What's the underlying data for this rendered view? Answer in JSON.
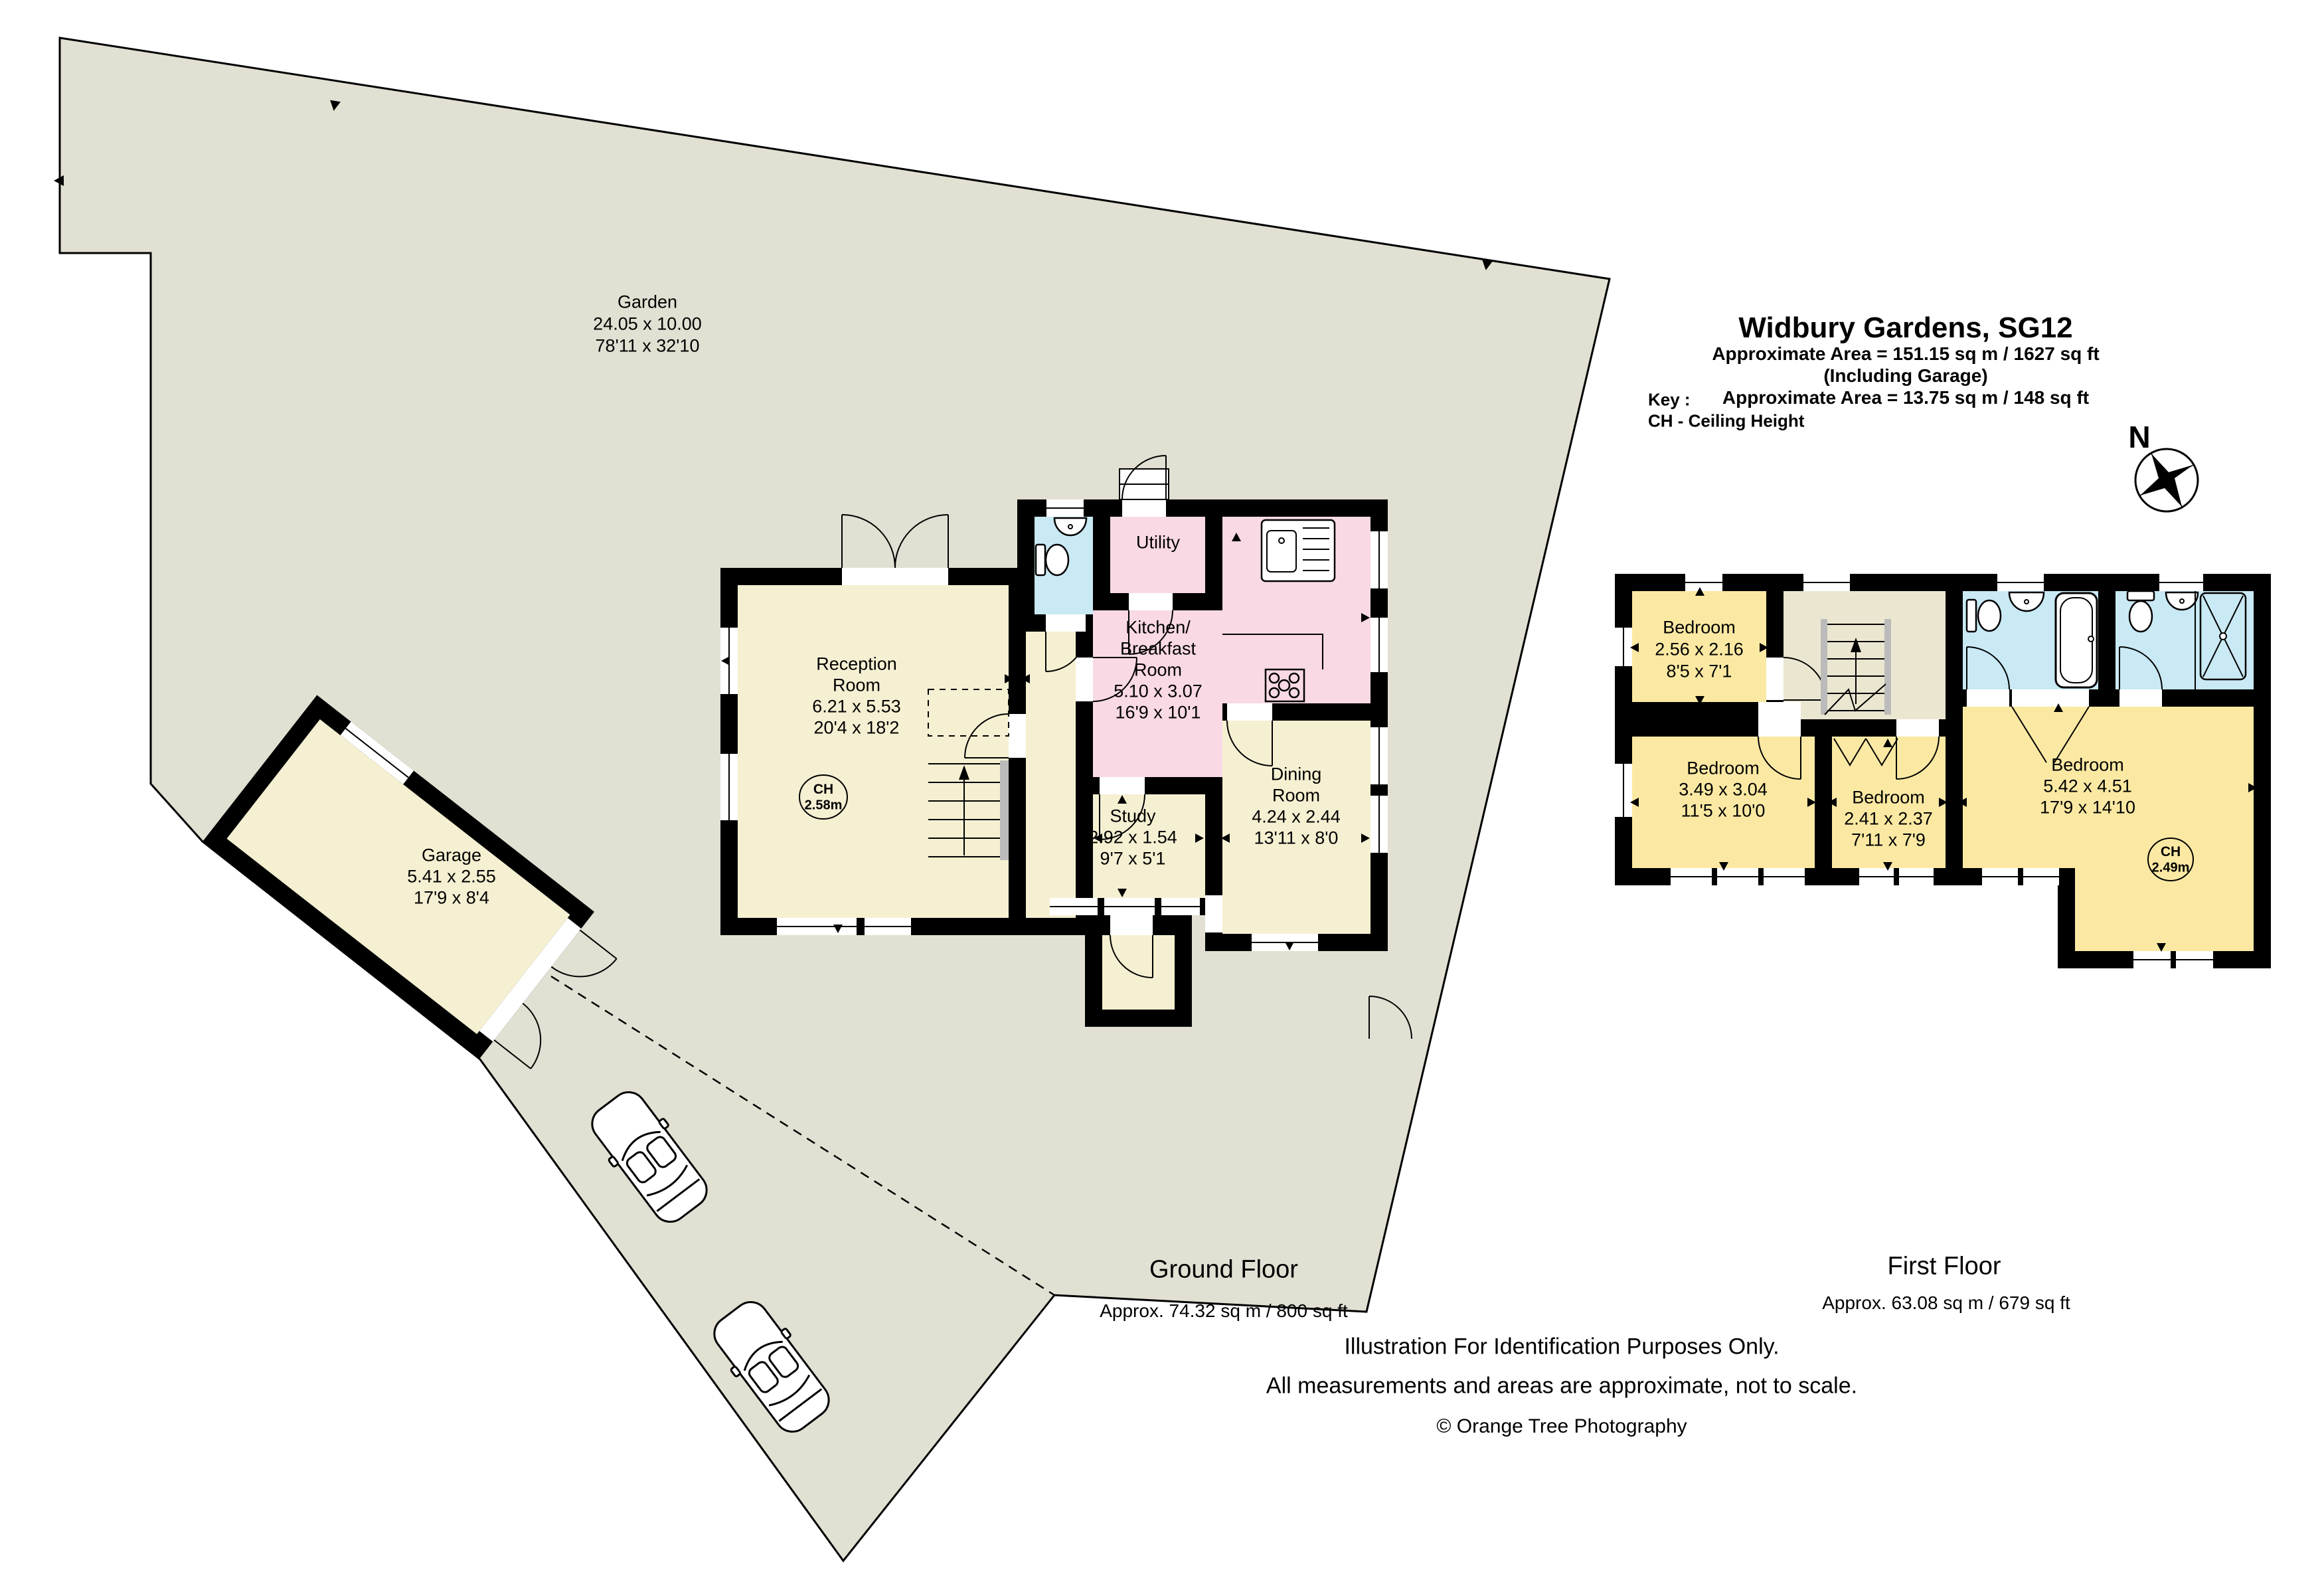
{
  "header": {
    "title": "Widbury Gardens, SG12",
    "area_line1": "Approximate Area =  151.15 sq m / 1627 sq ft",
    "area_line2": "(Including Garage)",
    "area_line3": "Approximate Area =  13.75 sq m / 148 sq ft"
  },
  "key": {
    "heading": "Key :",
    "item": "CH - Ceiling Height"
  },
  "compass": {
    "north": "N"
  },
  "garden": {
    "lines": [
      "Garden",
      "24.05 x 10.00",
      "78'11 x 32'10"
    ]
  },
  "ground_floor": {
    "label": "Ground Floor",
    "area": "Approx. 74.32 sq m / 800 sq ft",
    "reception": {
      "lines": [
        "Reception",
        "Room",
        "6.21 x 5.53",
        "20'4 x 18'2"
      ],
      "ch": [
        "CH",
        "2.58m"
      ]
    },
    "utility": {
      "lines": [
        "Utility"
      ]
    },
    "kitchen": {
      "lines": [
        "Kitchen/",
        "Breakfast",
        "Room",
        "5.10 x 3.07",
        "16'9 x 10'1"
      ]
    },
    "study": {
      "lines": [
        "Study",
        "2.92 x 1.54",
        "9'7 x 5'1"
      ]
    },
    "dining": {
      "lines": [
        "Dining",
        "Room",
        "4.24 x 2.44",
        "13'11 x 8'0"
      ]
    },
    "garage": {
      "lines": [
        "Garage",
        "5.41 x 2.55",
        "17'9 x 8'4"
      ]
    }
  },
  "first_floor": {
    "label": "First Floor",
    "area": "Approx. 63.08 sq m / 679 sq ft",
    "bedroom_small": {
      "lines": [
        "Bedroom",
        "2.56 x 2.16",
        "8'5 x 7'1"
      ]
    },
    "bedroom_left": {
      "lines": [
        "Bedroom",
        "3.49 x 3.04",
        "11'5 x 10'0"
      ]
    },
    "bedroom_middle": {
      "lines": [
        "Bedroom",
        "2.41 x 2.37",
        "7'11 x 7'9"
      ]
    },
    "bedroom_master": {
      "lines": [
        "Bedroom",
        "5.42 x 4.51",
        "17'9 x 14'10"
      ],
      "ch": [
        "CH",
        "2.49m"
      ]
    }
  },
  "footer": {
    "line1": "Illustration For Identification Purposes Only.",
    "line2": "All measurements and areas are approximate, not to scale.",
    "line3": "© Orange Tree Photography"
  },
  "colors": {
    "garden": "#E1E0D2",
    "room_cream": "#F5F0D2",
    "room_pink": "#F9D9E3",
    "room_blue": "#C9E9F4",
    "room_yellow": "#FBE9A3",
    "landing": "#EAE6D0",
    "wall": "#000000"
  }
}
